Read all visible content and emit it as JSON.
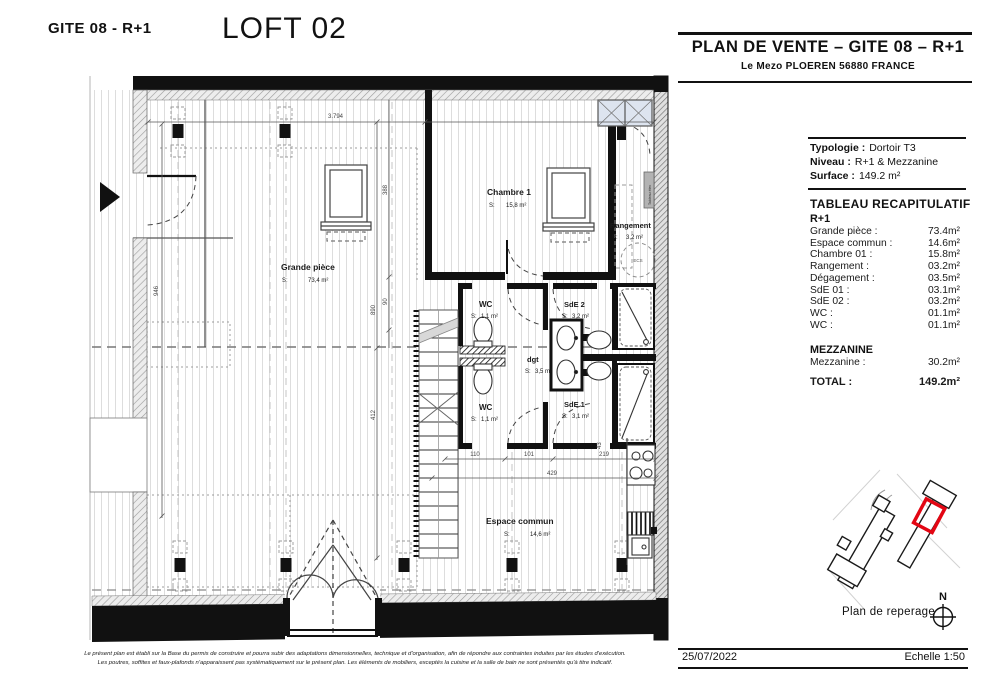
{
  "header": {
    "plan_ref": "GITE 08 - R+1",
    "loft_title": "LOFT 02"
  },
  "plan": {
    "rooms": [
      {
        "name": "Grande pièce",
        "s_label": "S:",
        "area": "73,4 m²"
      },
      {
        "name": "Chambre 1",
        "s_label": "S:",
        "area": "15,8 m²"
      },
      {
        "name": "Rangement",
        "s_label": "S:",
        "area": "3,2 m²"
      },
      {
        "name": "WC",
        "s_label": "S:",
        "area": "1,1 m²"
      },
      {
        "name": "SdE 2",
        "s_label": "S:",
        "area": "3,2 m²"
      },
      {
        "name": "dgt",
        "s_label": "S:",
        "area": "3,5 m²"
      },
      {
        "name": "WC",
        "s_label": "S:",
        "area": "1,1 m²"
      },
      {
        "name": "SdE 1",
        "s_label": "S:",
        "area": "3,1 m²"
      },
      {
        "name": "Espace commun",
        "s_label": "S:",
        "area": "14,6 m²"
      }
    ],
    "dimensions": {
      "top": "3.794",
      "left_v": "946",
      "v388": "388",
      "v890": "890",
      "v90": "90",
      "v412": "412",
      "v43": "43",
      "b110": "110",
      "b101": "101",
      "b219": "219",
      "b429": "429"
    },
    "annotations": {
      "ecs": "ECS",
      "tableau_elec": "Tableau élec"
    }
  },
  "panel": {
    "title": "PLAN DE VENTE – GITE 08 – R+1",
    "subtitle": "Le Mezo PLOEREN 56880 FRANCE",
    "info": [
      {
        "label": "Typologie :",
        "value": "Dortoir T3"
      },
      {
        "label": "Niveau :",
        "value": "R+1 & Mezzanine"
      },
      {
        "label": "Surface :",
        "value": "149.2 m²"
      }
    ],
    "table_title": "TABLEAU RECAPITULATIF",
    "section_r1": "R+1",
    "rows": [
      {
        "label": "Grande pièce :",
        "value": "73.4m²"
      },
      {
        "label": "Espace commun :",
        "value": "14.6m²"
      },
      {
        "label": "Chambre 01 :",
        "value": "15.8m²"
      },
      {
        "label": "Rangement :",
        "value": "03.2m²"
      },
      {
        "label": "Dégagement :",
        "value": "03.5m²"
      },
      {
        "label": "SdE 01 :",
        "value": "03.1m²"
      },
      {
        "label": "SdE 02 :",
        "value": "03.2m²"
      },
      {
        "label": "WC :",
        "value": "01.1m²"
      },
      {
        "label": "WC :",
        "value": "01.1m²"
      }
    ],
    "section_mezzanine": "MEZZANINE",
    "mezzanine_row": {
      "label": "Mezzanine :",
      "value": "30.2m²"
    },
    "total": {
      "label": "TOTAL :",
      "value": "149.2m²"
    },
    "map_caption": "Plan de reperage",
    "north": "N",
    "date": "25/07/2022",
    "scale": "Echelle 1:50"
  },
  "footer": {
    "disclaimer_line1": "Le présent plan est établi sur la Base du permis de construire et pourra subir des adaptations dimensionnelles, technique et d'organisation, afin de répondre aux contraintes induites par les études d'exécution.",
    "disclaimer_line2": "Les poutres, soffites et faux-plafonds n'apparaissent pas systématiquement sur le présent plan. Les éléments de mobiliers, exceptés la cuisine et la salle de bain ne sont présentés qu'à titre indicatif."
  },
  "colors": {
    "highlight_red": "#e30613",
    "wall_black": "#111111"
  }
}
